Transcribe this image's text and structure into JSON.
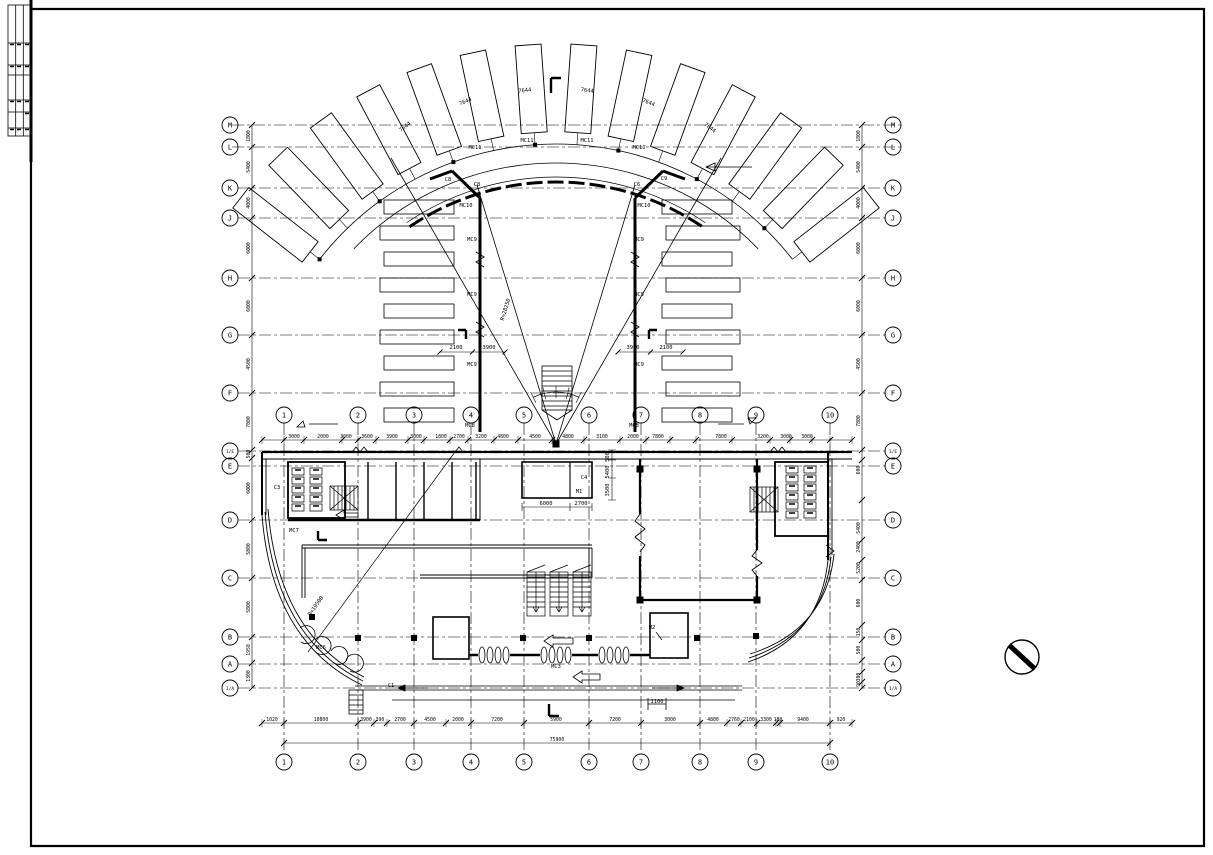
{
  "sheet": {
    "background": "#ffffff",
    "line_color": "#000000"
  },
  "title_block": {
    "columns": 3,
    "rows": 6
  },
  "north_symbol": {
    "type": "circle-with-diagonal"
  },
  "drawing": {
    "letter_axes": [
      {
        "id": "M",
        "y": 125
      },
      {
        "id": "L",
        "y": 147
      },
      {
        "id": "K",
        "y": 188
      },
      {
        "id": "J",
        "y": 218
      },
      {
        "id": "H",
        "y": 278
      },
      {
        "id": "G",
        "y": 335
      },
      {
        "id": "F",
        "y": 393
      },
      {
        "id": "1/E",
        "y": 451
      },
      {
        "id": "E",
        "y": 466
      },
      {
        "id": "D",
        "y": 520
      },
      {
        "id": "C",
        "y": 578
      },
      {
        "id": "B",
        "y": 637
      },
      {
        "id": "A",
        "y": 664
      },
      {
        "id": "1/A",
        "y": 688
      }
    ],
    "number_axes": [
      {
        "id": "1",
        "x": 284
      },
      {
        "id": "2",
        "x": 358
      },
      {
        "id": "3",
        "x": 414
      },
      {
        "id": "4",
        "x": 471
      },
      {
        "id": "5",
        "x": 524
      },
      {
        "id": "6",
        "x": 589
      },
      {
        "id": "7",
        "x": 641
      },
      {
        "id": "8",
        "x": 700
      },
      {
        "id": "9",
        "x": 756
      },
      {
        "id": "10",
        "x": 830
      }
    ],
    "number_rows": {
      "top_y": 415,
      "bottom_y": 762
    },
    "dims": {
      "left": {
        "line_x": 252,
        "circle_x": 230,
        "ticks": [
          125,
          147,
          188,
          218,
          278,
          335,
          393,
          450,
          458,
          520,
          578,
          637,
          663,
          688
        ],
        "labels": [
          {
            "y": 136,
            "t": "1800"
          },
          {
            "y": 167,
            "t": "5400"
          },
          {
            "y": 203,
            "t": "4000"
          },
          {
            "y": 248,
            "t": "6000"
          },
          {
            "y": 306,
            "t": "6000"
          },
          {
            "y": 364,
            "t": "4500"
          },
          {
            "y": 422,
            "t": "7800"
          },
          {
            "y": 454,
            "t": "500"
          },
          {
            "y": 488,
            "t": "6000"
          },
          {
            "y": 549,
            "t": "5800"
          },
          {
            "y": 607,
            "t": "5800"
          },
          {
            "y": 650,
            "t": "1950"
          },
          {
            "y": 676,
            "t": "1300"
          }
        ]
      },
      "right": {
        "line_x": 862,
        "circle_x": 893,
        "ticks": [
          125,
          147,
          188,
          218,
          278,
          335,
          393,
          450,
          460,
          500,
          540,
          560,
          580,
          625,
          640,
          660,
          672,
          682,
          688
        ],
        "labels": [
          {
            "y": 136,
            "t": "1800"
          },
          {
            "y": 167,
            "t": "5400"
          },
          {
            "y": 203,
            "t": "4000"
          },
          {
            "y": 248,
            "t": "6000"
          },
          {
            "y": 306,
            "t": "6000"
          },
          {
            "y": 364,
            "t": "4500"
          },
          {
            "y": 421,
            "t": "7800"
          },
          {
            "y": 470,
            "t": "600"
          },
          {
            "y": 528,
            "t": "5400"
          },
          {
            "y": 547,
            "t": "2400"
          },
          {
            "y": 568,
            "t": "5200"
          },
          {
            "y": 603,
            "t": "600"
          },
          {
            "y": 632,
            "t": "150"
          },
          {
            "y": 650,
            "t": "500"
          },
          {
            "y": 677,
            "t": "300"
          },
          {
            "y": 684,
            "t": "90"
          }
        ]
      },
      "bottom": {
        "line_y": 723,
        "ticks": [
          262,
          284,
          358,
          374,
          387,
          414,
          446,
          471,
          524,
          589,
          641,
          700,
          727,
          741,
          757,
          776,
          780,
          830,
          852
        ],
        "labels": [
          {
            "x": 272,
            "t": "1020"
          },
          {
            "x": 321,
            "t": "10800"
          },
          {
            "x": 366,
            "t": "3900"
          },
          {
            "x": 380,
            "t": "390"
          },
          {
            "x": 400,
            "t": "2700"
          },
          {
            "x": 430,
            "t": "4500"
          },
          {
            "x": 458,
            "t": "2000"
          },
          {
            "x": 497,
            "t": "7200"
          },
          {
            "x": 556,
            "t": "5900"
          },
          {
            "x": 615,
            "t": "7200"
          },
          {
            "x": 670,
            "t": "3000"
          },
          {
            "x": 713,
            "t": "4800"
          },
          {
            "x": 734,
            "t": "2760"
          },
          {
            "x": 749,
            "t": "2100"
          },
          {
            "x": 766,
            "t": "3300"
          },
          {
            "x": 778,
            "t": "180"
          },
          {
            "x": 803,
            "t": "9400"
          },
          {
            "x": 841,
            "t": "920"
          }
        ],
        "total": {
          "y": 743,
          "t": "75900"
        }
      },
      "mid": {
        "line_y": 440,
        "ticks": [
          262,
          284,
          304,
          342,
          358,
          376,
          408,
          424,
          450,
          468,
          494,
          518,
          552,
          584,
          620,
          646,
          670,
          696,
          732,
          770,
          790,
          812,
          830,
          852
        ],
        "labels": [
          {
            "x": 294,
            "t": "3000"
          },
          {
            "x": 323,
            "t": "2000"
          },
          {
            "x": 346,
            "t": "3000"
          },
          {
            "x": 367,
            "t": "3600"
          },
          {
            "x": 392,
            "t": "3900"
          },
          {
            "x": 416,
            "t": "3000"
          },
          {
            "x": 441,
            "t": "1800"
          },
          {
            "x": 459,
            "t": "2700"
          },
          {
            "x": 481,
            "t": "3200"
          },
          {
            "x": 503,
            "t": "4800"
          },
          {
            "x": 535,
            "t": "4500"
          },
          {
            "x": 568,
            "t": "4800"
          },
          {
            "x": 602,
            "t": "3100"
          },
          {
            "x": 633,
            "t": "2000"
          },
          {
            "x": 658,
            "t": "7800"
          },
          {
            "x": 721,
            "t": "7800"
          },
          {
            "x": 763,
            "t": "3200"
          },
          {
            "x": 786,
            "t": "3000"
          },
          {
            "x": 807,
            "t": "3000"
          }
        ]
      }
    },
    "fan": {
      "cx": 556,
      "cy": 444,
      "count": 14,
      "angle_start": -52,
      "angle_end": 52,
      "r_inner": 312,
      "r_outer": 400,
      "half_w": 13,
      "arc1_r": 300,
      "arc2_r": 281,
      "glass_r": 262,
      "glass_span": 34
    },
    "labels": [
      {
        "t": "MC11",
        "x": 475,
        "y": 149
      },
      {
        "t": "MC11",
        "x": 527,
        "y": 142
      },
      {
        "t": "MC11",
        "x": 587,
        "y": 142
      },
      {
        "t": "MC11",
        "x": 639,
        "y": 149
      },
      {
        "t": "7644",
        "x": 406,
        "y": 128,
        "r": -38
      },
      {
        "t": "7644",
        "x": 466,
        "y": 103,
        "r": -22
      },
      {
        "t": "7644",
        "x": 525,
        "y": 92,
        "r": -7
      },
      {
        "t": "7644",
        "x": 587,
        "y": 92,
        "r": 7
      },
      {
        "t": "7644",
        "x": 648,
        "y": 104,
        "r": 22
      },
      {
        "t": "7644",
        "x": 709,
        "y": 129,
        "r": 38
      },
      {
        "t": "C8",
        "x": 448,
        "y": 181
      },
      {
        "t": "C8",
        "x": 477,
        "y": 186
      },
      {
        "t": "C6",
        "x": 637,
        "y": 186
      },
      {
        "t": "C9",
        "x": 664,
        "y": 180
      },
      {
        "t": "MC10",
        "x": 466,
        "y": 207
      },
      {
        "t": "MC10",
        "x": 644,
        "y": 207
      },
      {
        "t": "MC9",
        "x": 472,
        "y": 241
      },
      {
        "t": "MC9",
        "x": 472,
        "y": 296
      },
      {
        "t": "MC9",
        "x": 472,
        "y": 366
      },
      {
        "t": "MC9",
        "x": 639,
        "y": 241
      },
      {
        "t": "MC9",
        "x": 639,
        "y": 296
      },
      {
        "t": "MC9",
        "x": 639,
        "y": 366
      },
      {
        "t": "MC8",
        "x": 470,
        "y": 427
      },
      {
        "t": "MC8",
        "x": 634,
        "y": 427
      },
      {
        "t": "R=28250",
        "x": 507,
        "y": 310,
        "r": -73
      },
      {
        "t": "R=19500",
        "x": 317,
        "y": 607,
        "r": -55
      },
      {
        "t": "2100",
        "x": 456,
        "y": 349
      },
      {
        "t": "3900",
        "x": 489,
        "y": 349
      },
      {
        "t": "3900",
        "x": 633,
        "y": 349
      },
      {
        "t": "2100",
        "x": 666,
        "y": 349
      },
      {
        "t": "C3",
        "x": 277,
        "y": 489
      },
      {
        "t": "MC7",
        "x": 294,
        "y": 532
      },
      {
        "t": "C4",
        "x": 584,
        "y": 479
      },
      {
        "t": "M1",
        "x": 579,
        "y": 493
      },
      {
        "t": "M2",
        "x": 652,
        "y": 629
      },
      {
        "t": "MC6",
        "x": 321,
        "y": 649
      },
      {
        "t": "C1",
        "x": 391,
        "y": 687
      },
      {
        "t": "MC3",
        "x": 556,
        "y": 668
      },
      {
        "t": "6000",
        "x": 546,
        "y": 505
      },
      {
        "t": "2700",
        "x": 581,
        "y": 505
      },
      {
        "t": "500",
        "x": 609,
        "y": 457,
        "r": -90
      },
      {
        "t": "5400",
        "x": 609,
        "y": 472,
        "r": -90
      },
      {
        "t": "3500",
        "x": 609,
        "y": 490,
        "r": -90
      },
      {
        "t": "1100",
        "x": 657,
        "y": 703
      }
    ]
  }
}
